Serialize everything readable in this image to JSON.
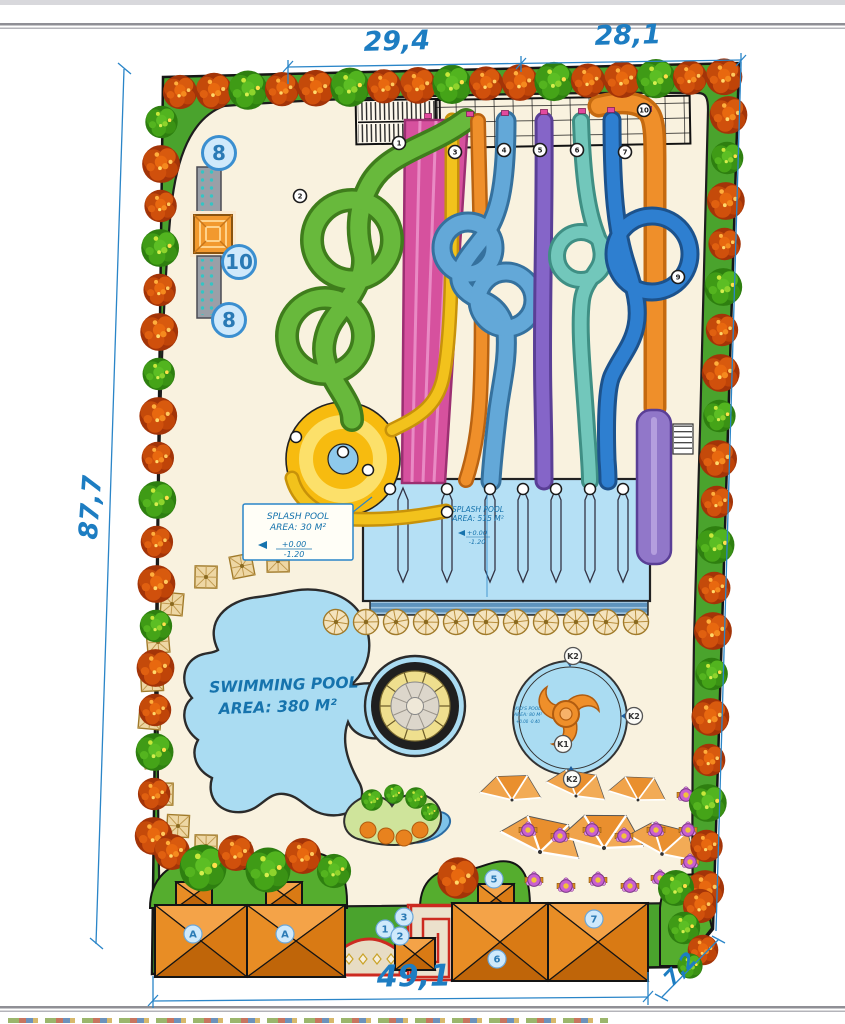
{
  "colors": {
    "accent_blue": "#1d7dc2",
    "site_green": "#4aa32d",
    "deck_cream": "#f9f2df",
    "water_blue": "#aadcf2",
    "roof_orange": "#e8871f"
  },
  "dims": {
    "top_left": "29,4",
    "top_right": "28,1",
    "left": "87,7",
    "bottom": "49,1",
    "corner": "7,2"
  },
  "pools": {
    "splash_box": {
      "l1": "SPLASH POOL",
      "l2": "AREA: 30 M²",
      "lv1": "+0.00",
      "lv2": "-1.20"
    },
    "splash_main": {
      "l1": "SPLASH POOL",
      "l2": "AREA: 515 M²",
      "lv1": "+0.00",
      "lv2": "-1.20"
    },
    "swim": {
      "l1": "SWIMMING POOL",
      "l2": "AREA: 380 M²"
    },
    "kids": {
      "l1": "KID'S POOL",
      "l2": "AREA: 80 M²",
      "lv": "+0.00  -0.40"
    }
  },
  "amenity_markers": {
    "m8a": "8",
    "m10": "10",
    "m8b": "8"
  },
  "kids_markers": {
    "k1": "K1",
    "k2a": "K2",
    "k2b": "K2",
    "k2c": "K2"
  },
  "building_labels": {
    "a1": "A",
    "a2": "A",
    "n1": "1",
    "n2": "2",
    "n3": "3",
    "n5": "5",
    "n6": "6",
    "n7": "7"
  },
  "slide_markers": {
    "s1": "1",
    "s2": "2",
    "s3": "3",
    "s4": "4",
    "s5": "5",
    "s6": "6",
    "s7": "7",
    "s9": "9",
    "s10": "10"
  }
}
